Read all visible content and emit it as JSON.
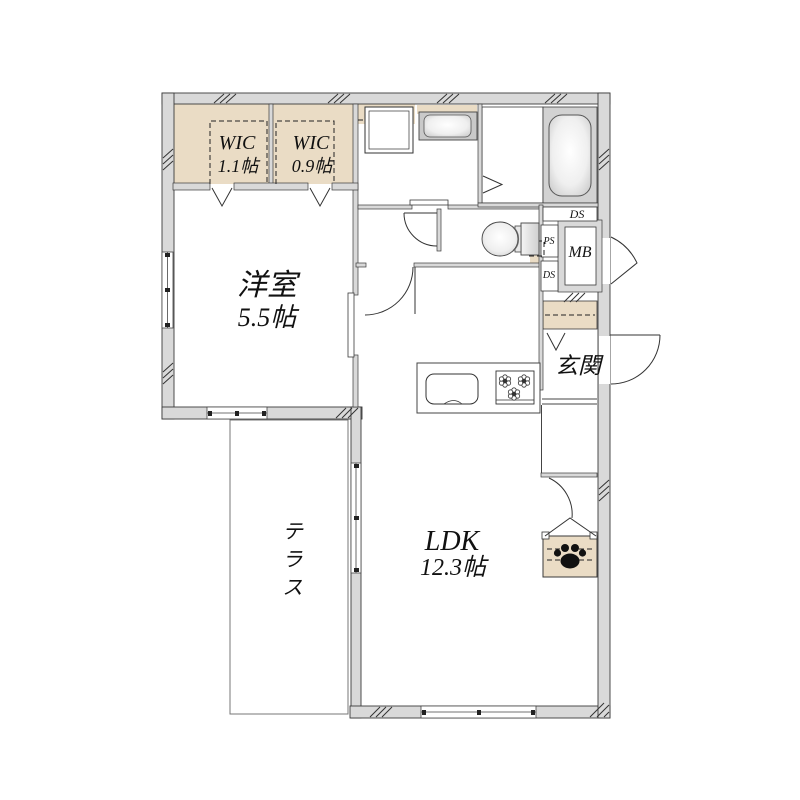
{
  "plan": {
    "rooms": {
      "wic1": {
        "name": "WIC",
        "size": "1.1帖"
      },
      "wic2": {
        "name": "WIC",
        "size": "0.9帖"
      },
      "western_room": {
        "name": "洋室",
        "size": "5.5帖"
      },
      "ldk": {
        "name": "LDK",
        "size": "12.3帖"
      },
      "terrace": {
        "name": "テラス"
      },
      "entrance": {
        "name": "玄関"
      }
    },
    "labels": {
      "meter_box": "MB",
      "duct_space_top": "DS",
      "pipe_space": "PS",
      "duct_space_bottom": "DS"
    },
    "colors": {
      "wall_fill": "#d9d9d9",
      "closet_fill": "#eadcc5",
      "bath_fill": "#d2d2d2",
      "outline": "#3a3a3a"
    },
    "icons": {
      "pet_storage": "paw-print"
    }
  }
}
